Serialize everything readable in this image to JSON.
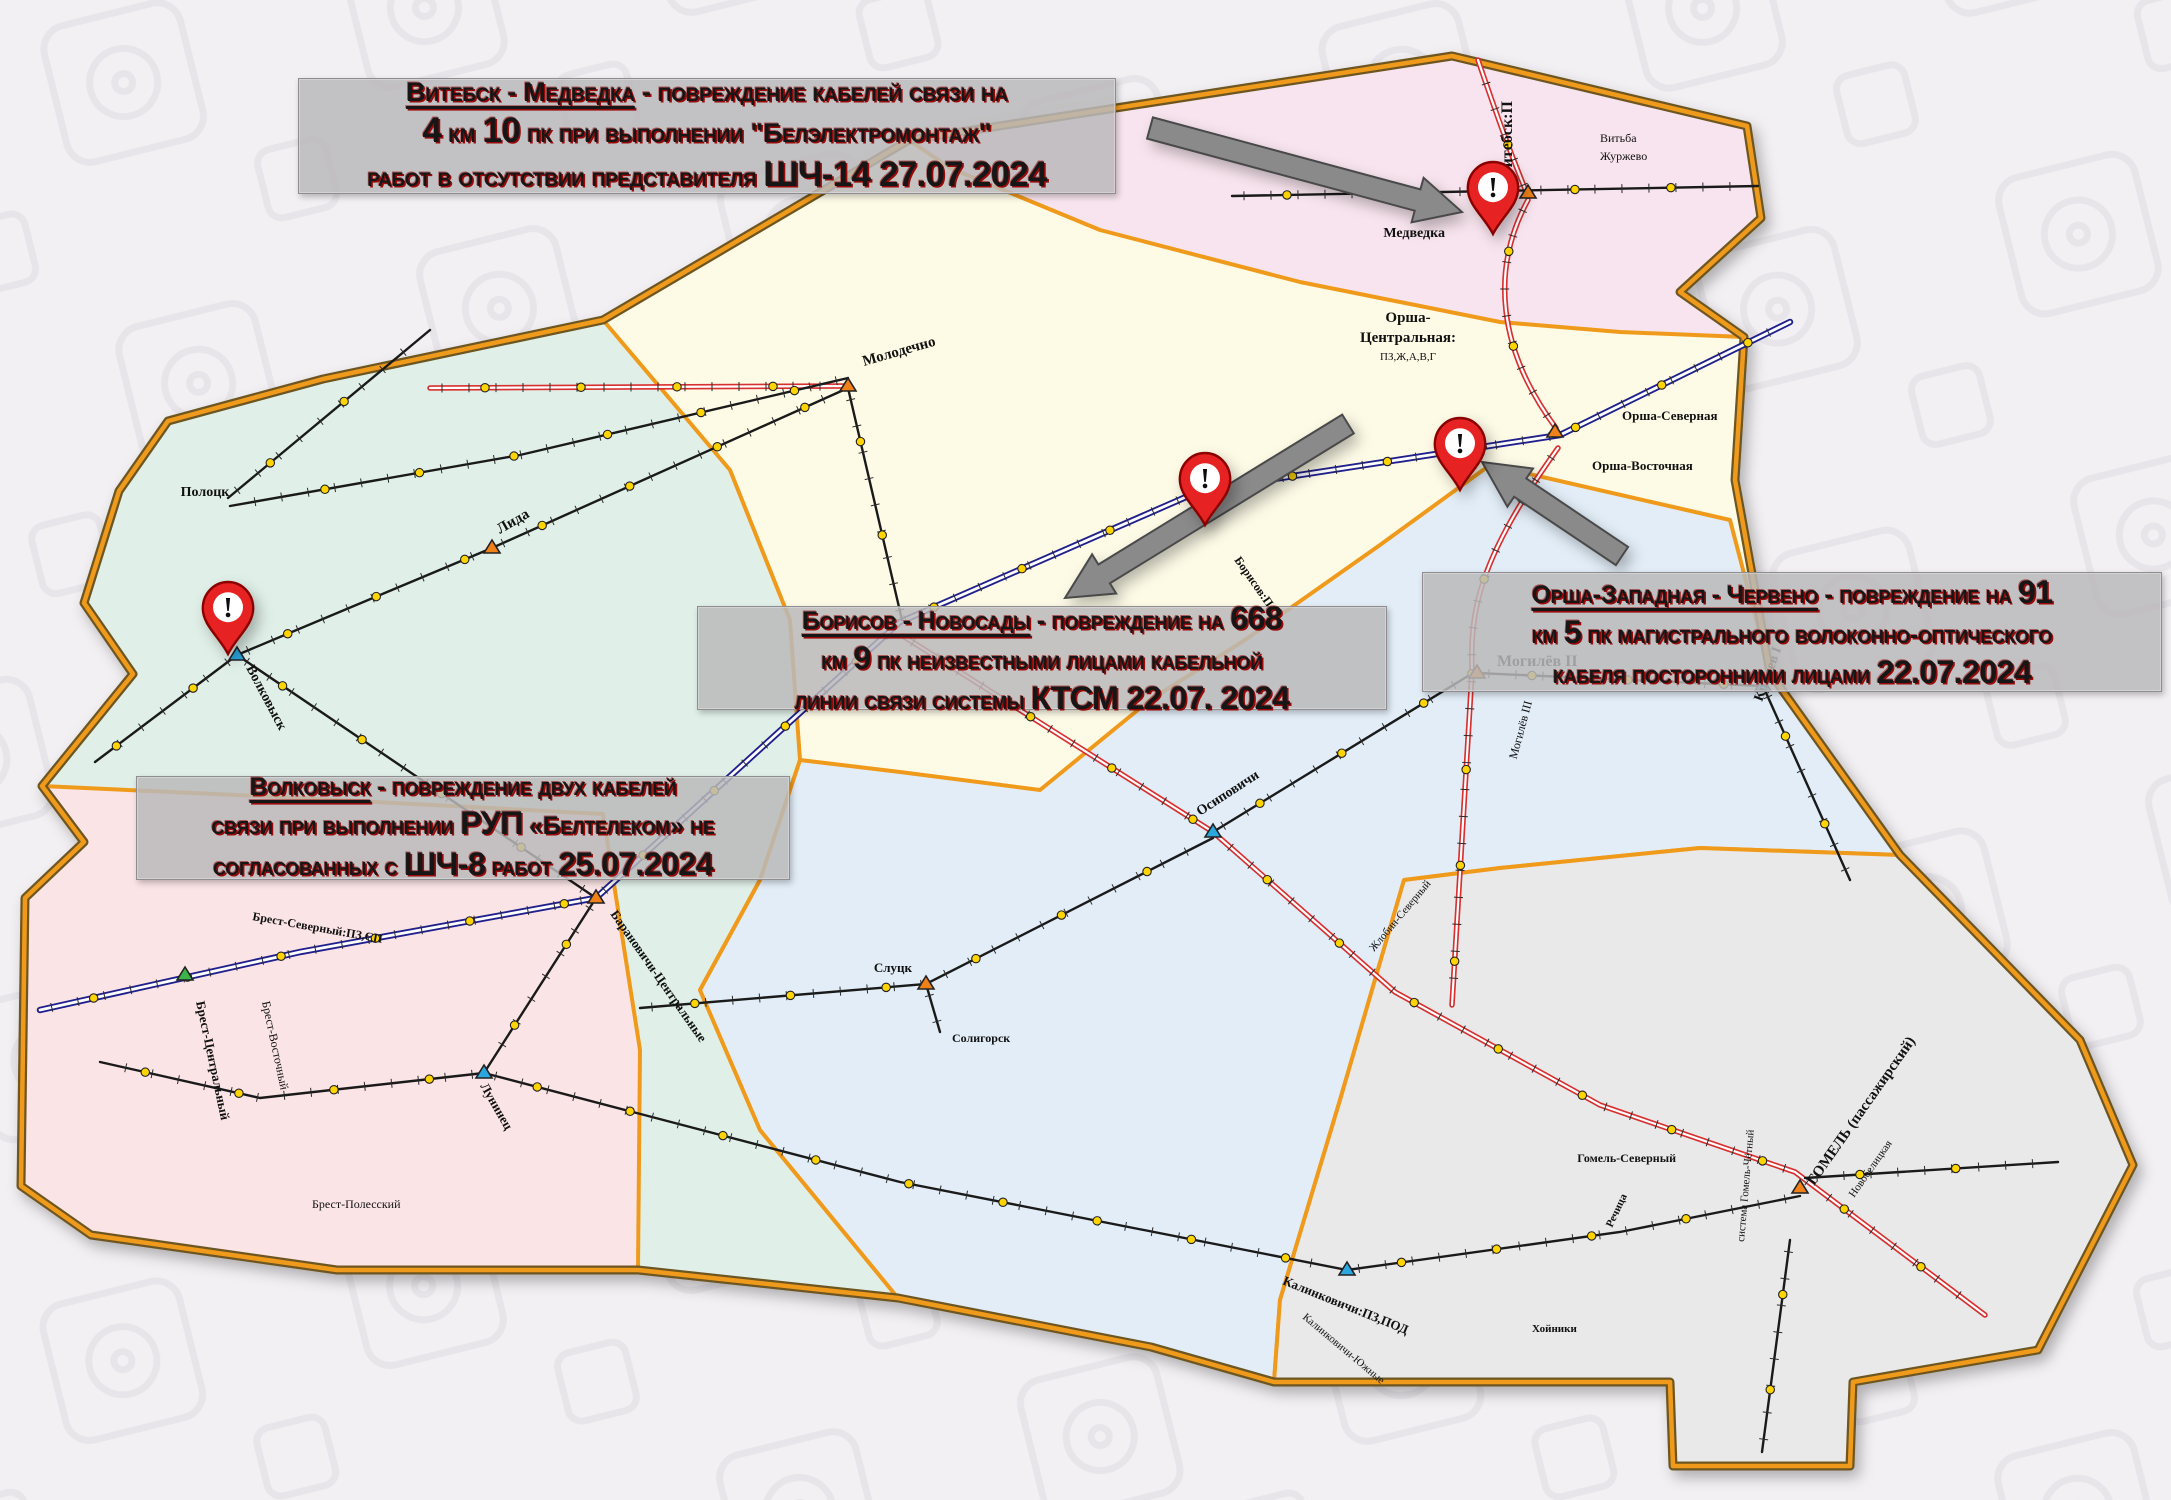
{
  "colors": {
    "background": "#f2f0f3",
    "watermark": "#e6e3e8",
    "region_minsk": "#fdfae6",
    "region_vitebsk": "#f8e4ee",
    "region_west": "#e0f0e8",
    "region_mogilev": "#e2edf7",
    "region_brest": "#fbe4e6",
    "region_gomel": "#e9e9ea",
    "border_orange": "#f09a1c",
    "border_dark": "#6e5620",
    "rail_red": "#d83030",
    "rail_blue": "#20208c",
    "rail_black": "#1a1a1a",
    "station_dot": "#ffd400",
    "pin_red": "#e62020",
    "pin_dark": "#8a0000",
    "arrow_gray": "#8a8a8a",
    "arrow_edge": "#4a4a4a",
    "callout_text": "#161616",
    "callout_shadow": "#960000"
  },
  "callouts": [
    {
      "id": "vitebsk-medvedka",
      "box": {
        "x": 298,
        "y": 78,
        "w": 816,
        "h": 114
      },
      "font_px": 27,
      "lines": [
        [
          {
            "t": "Витебск - Медведка",
            "u": 1
          },
          {
            "t": " - повреждение кабелей связи на"
          }
        ],
        [
          {
            "t": "4",
            "b": 1
          },
          {
            "t": " км "
          },
          {
            "t": "10",
            "b": 1
          },
          {
            "t": " пк при выполнении \"Белэлектромонтаж\""
          }
        ],
        [
          {
            "t": "работ в отсутствии представителя "
          },
          {
            "t": "ШЧ-14 27.07.2024",
            "b": 1
          }
        ]
      ]
    },
    {
      "id": "borisov-novosady",
      "box": {
        "x": 697,
        "y": 606,
        "w": 688,
        "h": 102
      },
      "font_px": 25,
      "lines": [
        [
          {
            "t": "Борисов - Новосады",
            "u": 1
          },
          {
            "t": " - повреждение  на "
          },
          {
            "t": "668",
            "b": 1
          }
        ],
        [
          {
            "t": "км "
          },
          {
            "t": "9",
            "b": 1
          },
          {
            "t": " пк неизвестными лицами кабельной"
          }
        ],
        [
          {
            "t": "линии связи системы "
          },
          {
            "t": "КТСМ 22.07. 2024",
            "b": 1
          }
        ]
      ]
    },
    {
      "id": "orsha-zapadnaya-cherveno",
      "box": {
        "x": 1422,
        "y": 572,
        "w": 738,
        "h": 118
      },
      "font_px": 25,
      "lines": [
        [
          {
            "t": "Орша-Западная - Червено",
            "u": 1
          },
          {
            "t": " - повреждение на "
          },
          {
            "t": "91",
            "b": 1
          }
        ],
        [
          {
            "t": "км "
          },
          {
            "t": "5",
            "b": 1
          },
          {
            "t": " пк магистрального волоконно-оптического"
          }
        ],
        [
          {
            "t": "кабеля посторонними лицами "
          },
          {
            "t": "22.07.2024",
            "b": 1
          }
        ]
      ]
    },
    {
      "id": "volkovysk",
      "box": {
        "x": 136,
        "y": 776,
        "w": 652,
        "h": 102
      },
      "font_px": 25,
      "lines": [
        [
          {
            "t": "Волковыск",
            "u": 1
          },
          {
            "t": " - повреждение двух кабелей"
          }
        ],
        [
          {
            "t": "связи при выполнении "
          },
          {
            "t": "РУП",
            "b": 1
          },
          {
            "t": " «Белтелеком» не"
          }
        ],
        [
          {
            "t": "согласованных с "
          },
          {
            "t": "ШЧ-8",
            "b": 1
          },
          {
            "t": "  работ "
          },
          {
            "t": "25.07.2024",
            "b": 1
          }
        ]
      ]
    }
  ],
  "map": {
    "labels": [
      {
        "n": "Витебск:П",
        "x": 1512,
        "y": 178,
        "r": -90,
        "a": "start",
        "fs": 16,
        "b": 1
      },
      {
        "n": "Медведка",
        "x": 1445,
        "y": 237,
        "a": "end",
        "fs": 14,
        "b": 1
      },
      {
        "n": "Витьба",
        "x": 1600,
        "y": 142,
        "a": "start",
        "fs": 12
      },
      {
        "n": "Журжево",
        "x": 1600,
        "y": 160,
        "a": "start",
        "fs": 12
      },
      {
        "n": "Орша-",
        "x": 1408,
        "y": 322,
        "a": "middle",
        "fs": 15,
        "b": 1
      },
      {
        "n": "Центральная:",
        "x": 1408,
        "y": 342,
        "a": "middle",
        "fs": 15,
        "b": 1
      },
      {
        "n": "ПЗ,Ж,А,В,Г",
        "x": 1408,
        "y": 360,
        "a": "middle",
        "fs": 11
      },
      {
        "n": "Орша-Северная",
        "x": 1622,
        "y": 420,
        "a": "start",
        "fs": 13,
        "b": 1
      },
      {
        "n": "Орша-Восточная",
        "x": 1592,
        "y": 470,
        "a": "start",
        "fs": 13,
        "b": 1
      },
      {
        "n": "Могилёв II",
        "x": 1497,
        "y": 666,
        "a": "start",
        "fs": 16,
        "b": 1
      },
      {
        "n": "Могилёв III",
        "x": 1532,
        "y": 702,
        "r": -75,
        "a": "end",
        "fs": 12
      },
      {
        "n": "Кричев I",
        "x": 1762,
        "y": 702,
        "r": -70,
        "a": "start",
        "fs": 14,
        "b": 1
      },
      {
        "n": "Молодечно",
        "x": 864,
        "y": 366,
        "r": -16,
        "a": "start",
        "fs": 15,
        "b": 1
      },
      {
        "n": "Лида",
        "x": 500,
        "y": 534,
        "r": -30,
        "a": "start",
        "fs": 15,
        "b": 1
      },
      {
        "n": "Полоцк",
        "x": 205,
        "y": 496,
        "a": "middle",
        "fs": 14,
        "b": 1
      },
      {
        "n": "Волковыск",
        "x": 246,
        "y": 668,
        "r": 62,
        "a": "start",
        "fs": 14,
        "b": 1
      },
      {
        "n": "Барановичи-Центральные",
        "x": 610,
        "y": 914,
        "r": 55,
        "a": "start",
        "fs": 13,
        "b": 1
      },
      {
        "n": "Лунинец",
        "x": 480,
        "y": 1086,
        "r": 60,
        "a": "start",
        "fs": 13,
        "b": 1
      },
      {
        "n": "Брест-Северный:ПЗ,СП",
        "x": 252,
        "y": 920,
        "r": 10,
        "a": "start",
        "fs": 12,
        "b": 1
      },
      {
        "n": "Брест-Центральный",
        "x": 196,
        "y": 1002,
        "r": 78,
        "a": "start",
        "fs": 13,
        "b": 1
      },
      {
        "n": "Брест-Восточный",
        "x": 262,
        "y": 1002,
        "r": 78,
        "a": "start",
        "fs": 12
      },
      {
        "n": "Брест-Полесский",
        "x": 312,
        "y": 1208,
        "a": "start",
        "fs": 12
      },
      {
        "n": "Осиповичи",
        "x": 1200,
        "y": 816,
        "r": -33,
        "a": "start",
        "fs": 14,
        "b": 1
      },
      {
        "n": "Борисов:П",
        "x": 1234,
        "y": 560,
        "r": 55,
        "a": "start",
        "fs": 12,
        "b": 1
      },
      {
        "n": "Слуцк",
        "x": 912,
        "y": 972,
        "a": "end",
        "fs": 13,
        "b": 1
      },
      {
        "n": "Солигорск",
        "x": 952,
        "y": 1042,
        "a": "start",
        "fs": 12,
        "b": 1
      },
      {
        "n": "Жлобин-Северный",
        "x": 1374,
        "y": 952,
        "r": -50,
        "a": "start",
        "fs": 11
      },
      {
        "n": "Калинковичи:ПЗ,ПОД",
        "x": 1282,
        "y": 1284,
        "r": 22,
        "a": "start",
        "fs": 13,
        "b": 1
      },
      {
        "n": "Калинковичи-Южные",
        "x": 1302,
        "y": 1318,
        "r": 40,
        "a": "start",
        "fs": 11
      },
      {
        "n": "Гомель-Северный",
        "x": 1676,
        "y": 1162,
        "a": "end",
        "fs": 12,
        "b": 1
      },
      {
        "n": "система Гомель-Чётный",
        "x": 1744,
        "y": 1242,
        "r": -85,
        "a": "start",
        "fs": 11
      },
      {
        "n": "ГОМЕЛЬ (пассажирский)",
        "x": 1814,
        "y": 1186,
        "r": -55,
        "a": "start",
        "fs": 15,
        "b": 1
      },
      {
        "n": "Новобелицкая",
        "x": 1854,
        "y": 1198,
        "r": -55,
        "a": "start",
        "fs": 11
      },
      {
        "n": "Речица",
        "x": 1612,
        "y": 1228,
        "r": -65,
        "a": "start",
        "fs": 11,
        "b": 1
      },
      {
        "n": "Хойники",
        "x": 1532,
        "y": 1332,
        "a": "start",
        "fs": 11,
        "b": 1
      }
    ],
    "hubs": [
      [
        1528,
        193,
        "#f08018"
      ],
      [
        1555,
        432,
        "#f08018"
      ],
      [
        1477,
        673,
        "#f08018"
      ],
      [
        848,
        386,
        "#f08018"
      ],
      [
        492,
        548,
        "#f08018"
      ],
      [
        237,
        655,
        "#2aa7df"
      ],
      [
        596,
        898,
        "#f08018"
      ],
      [
        484,
        1073,
        "#2aa7df"
      ],
      [
        185,
        975,
        "#3cb44a"
      ],
      [
        1213,
        832,
        "#2aa7df"
      ],
      [
        1800,
        1188,
        "#f08018"
      ],
      [
        1347,
        1270,
        "#2aa7df"
      ],
      [
        1763,
        686,
        "#2aa7df"
      ],
      [
        926,
        984,
        "#f08018"
      ]
    ],
    "pins": [
      {
        "id": "pin-vitebsk-medvedka",
        "x": 1493,
        "y": 234
      },
      {
        "id": "pin-borisov-novosady",
        "x": 1205,
        "y": 525
      },
      {
        "id": "pin-orsha-zapadnaya",
        "x": 1460,
        "y": 490
      },
      {
        "id": "pin-volkovysk",
        "x": 228,
        "y": 654
      }
    ],
    "arrows": [
      {
        "id": "arrow-to-vitebsk",
        "x1": 1150,
        "y1": 128,
        "x2": 1462,
        "y2": 212
      },
      {
        "id": "arrow-to-borisov",
        "x1": 1348,
        "y1": 424,
        "x2": 1065,
        "y2": 598
      },
      {
        "id": "arrow-to-orsha",
        "x1": 1622,
        "y1": 556,
        "x2": 1482,
        "y2": 462
      }
    ]
  }
}
